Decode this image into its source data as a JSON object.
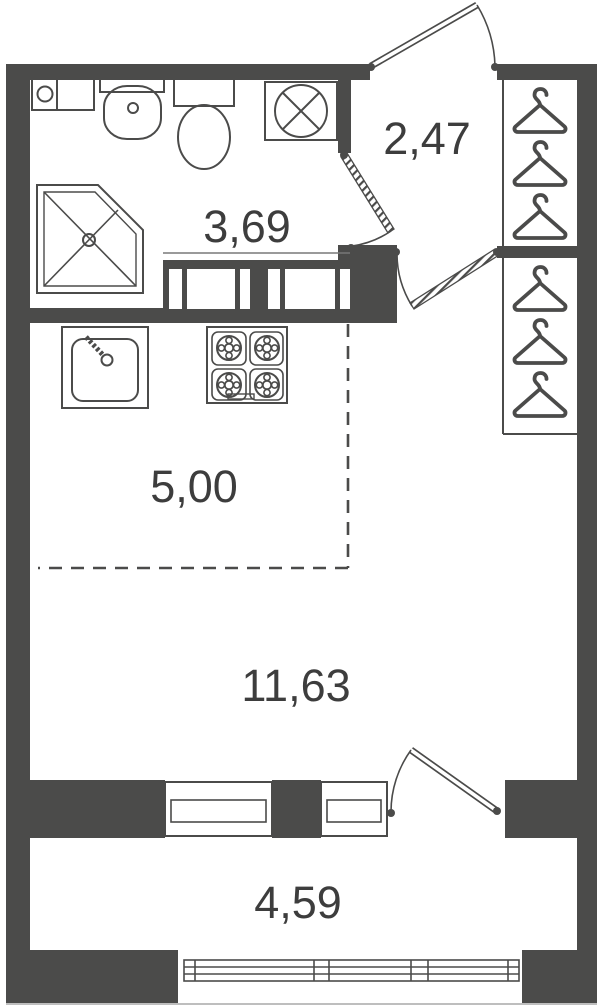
{
  "plan": {
    "rooms": [
      {
        "name": "hallway",
        "area": "2,47"
      },
      {
        "name": "bathroom",
        "area": "3,69"
      },
      {
        "name": "kitchen-zone",
        "area": "5,00"
      },
      {
        "name": "living-room",
        "area": "11,63"
      },
      {
        "name": "balcony",
        "area": "4,59"
      }
    ],
    "fixtures": {
      "bathroom": [
        "storage-unit",
        "washbasin",
        "toilet",
        "washing-machine",
        "shower"
      ],
      "kitchen": [
        "sink",
        "stove-4-burners"
      ],
      "wardrobe": {
        "sections": 2,
        "hangers_per_section": 3
      },
      "openings": [
        "entry-door",
        "bathroom-door",
        "living-room-door",
        "balcony-door",
        "window",
        "window",
        "balcony-glazing"
      ]
    },
    "colors": {
      "wall": "#4b4b4a",
      "fixture_line": "#4b4b4a",
      "label_text": "#3d3d3d",
      "background": "#ffffff"
    }
  }
}
